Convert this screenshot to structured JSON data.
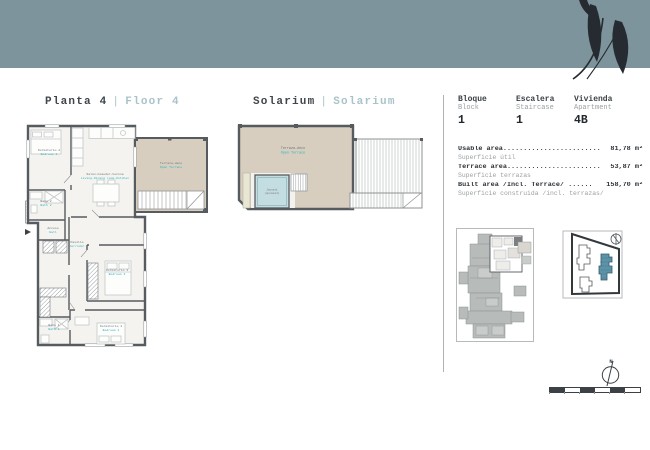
{
  "titles": {
    "plan": {
      "es": "Planta 4",
      "sep": "|",
      "en": "Floor 4"
    },
    "solarium": {
      "es": "Solarium",
      "sep": "|",
      "en": "Solarium"
    }
  },
  "unit_info": {
    "columns": [
      {
        "es": "Bloque",
        "en": "Block",
        "value": "1"
      },
      {
        "es": "Escalera",
        "en": "Staircase",
        "value": "1"
      },
      {
        "es": "Vivienda",
        "en": "Apartment",
        "value": "4B"
      }
    ],
    "areas": [
      {
        "label": "Usable area........................",
        "value": "81,78 m²",
        "sub": "Superficie útil"
      },
      {
        "label": "Terrace area.......................",
        "value": "53,87 m²",
        "sub": "Superficie terrazas"
      },
      {
        "label": "Built area /Incl. Terrace/ ......",
        "value": "158,70 m²",
        "sub": "Superficie construida /incl. terrazas/"
      }
    ]
  },
  "floorplan_rooms": {
    "bedroom2": {
      "es": "Dormitorio 2",
      "en": "Bedroom 2"
    },
    "living": {
      "es": "Salón-Comedor-Cocina",
      "en": "Living-Dining room-Kitchen"
    },
    "terrace": {
      "es": "Terraza-deco",
      "en": "Open Terrace"
    },
    "bath2": {
      "es": "Baño 2",
      "en": "Bath 2"
    },
    "hall": {
      "es": "Acceso",
      "en": "Hall"
    },
    "corridor": {
      "es": "Pasillo",
      "en": "Corridor"
    },
    "bedroom3": {
      "es": "Dormitorio 3",
      "en": "Bedroom 3"
    },
    "bedroom1": {
      "es": "Dormitorio 1",
      "en": "Bedroom 1"
    },
    "bath1": {
      "es": "Baño 1",
      "en": "Bath 1"
    }
  },
  "solarium_plan": {
    "terrace": {
      "es": "Terraza-deco",
      "en": "Open Terrace"
    },
    "jacuzzi": {
      "line1": "Jacuzzi",
      "line2": "(opcional)"
    }
  },
  "compass": {
    "label": "N"
  },
  "colors": {
    "band": "#7d949c",
    "accent_teal": "#2ab4bb",
    "terrace_beige": "#d8cec0",
    "site_highlight": "#5d93a7",
    "title_light": "#a8c4c9"
  }
}
